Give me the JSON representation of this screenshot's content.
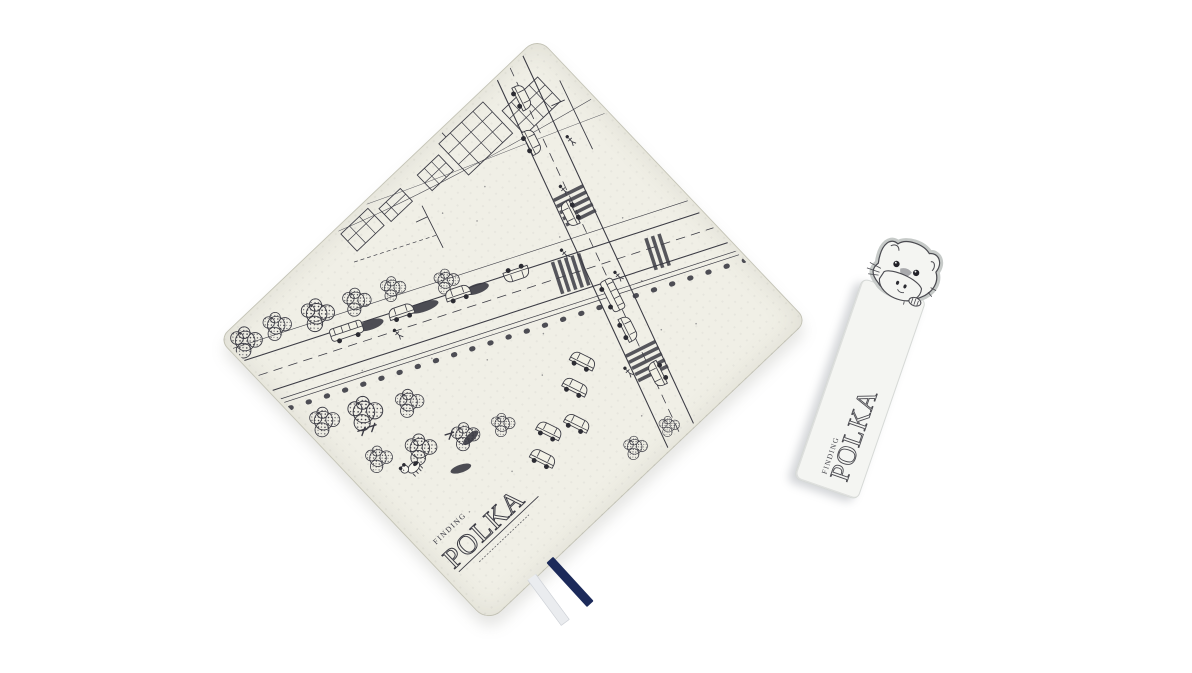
{
  "scene": {
    "background_color": "#ffffff",
    "description_items": [
      "notebook-cover-with-city-sketch",
      "character-bookmark"
    ]
  },
  "cover": {
    "fabric_color": "#f0efe6",
    "ink_color": "#3b3b44",
    "logo": {
      "finding": "FINDING",
      "polka": "POLKA"
    },
    "ribbons": {
      "white": "#eaecef",
      "navy": "#1c2a5a"
    }
  },
  "bookmark": {
    "paper_color": "#f4f5f2",
    "ink_color": "#4a4a50",
    "character": "puppy-peeking-over-edge",
    "logo": {
      "finding": "FINDING",
      "polka": "POLKA"
    }
  }
}
